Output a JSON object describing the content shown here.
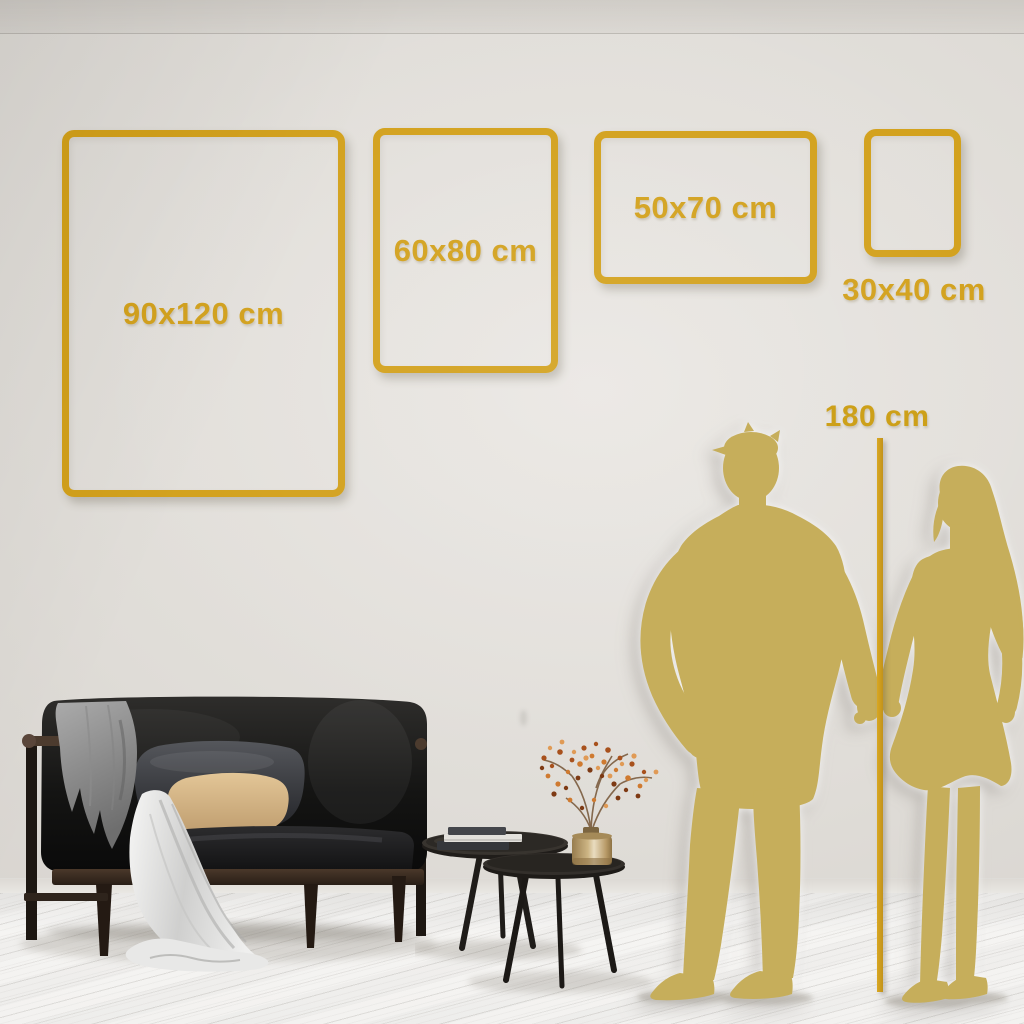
{
  "size_guide": {
    "frames": [
      {
        "label": "90x120 cm"
      },
      {
        "label": "60x80 cm"
      },
      {
        "label": "50x70 cm"
      },
      {
        "label": "30x40 cm"
      }
    ],
    "height_marker": {
      "label": "180 cm"
    }
  },
  "colors": {
    "accent_gold": "#D2A01A",
    "silhouette_gold": "#C6AE5B",
    "wall": "#E0DDD8",
    "floor": "#F3F2F0"
  },
  "scene": {
    "objects": [
      "sofa",
      "throw-blanket",
      "draped-cloth",
      "cushions",
      "nesting-coffee-tables",
      "stacked-books",
      "brass-vase",
      "dried-branch",
      "man-silhouette",
      "woman-silhouette"
    ]
  }
}
